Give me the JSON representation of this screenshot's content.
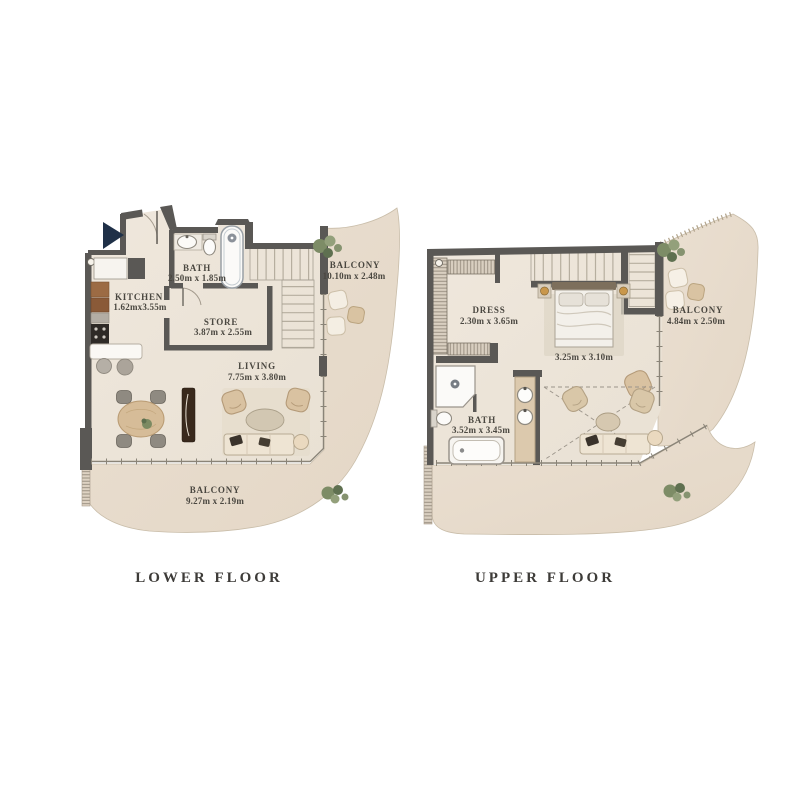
{
  "lower_floor": {
    "title": "LOWER FLOOR",
    "rooms": {
      "bath": {
        "name": "BATH",
        "dims": "2.50m x 1.85m"
      },
      "kitchen": {
        "name": "KITCHEN",
        "dims": "1.62mx3.55m"
      },
      "store": {
        "name": "STORE",
        "dims": "3.87m x 2.55m"
      },
      "living": {
        "name": "LIVING",
        "dims": "7.75m x 3.80m"
      },
      "balcony_side": {
        "name": "BALCONY",
        "dims": "10.10m x 2.48m"
      },
      "balcony_bottom": {
        "name": "BALCONY",
        "dims": "9.27m x 2.19m"
      }
    }
  },
  "upper_floor": {
    "title": "UPPER FLOOR",
    "rooms": {
      "dress": {
        "name": "DRESS",
        "dims": "2.30m x 3.65m"
      },
      "bedroom": {
        "dims": "3.25m x 3.10m"
      },
      "bath": {
        "name": "BATH",
        "dims": "3.52m x 3.45m"
      },
      "balcony": {
        "name": "BALCONY",
        "dims": "4.84m x 2.50m"
      }
    }
  },
  "colors": {
    "wall": "#5a5855",
    "interior_floor": "#ede5da",
    "outdoor_floor": "#e8dccd",
    "label_text": "#4a4740",
    "wood": "#d6bc98",
    "entry_arrow": "#1f3048",
    "plant": "#7d8c66"
  }
}
